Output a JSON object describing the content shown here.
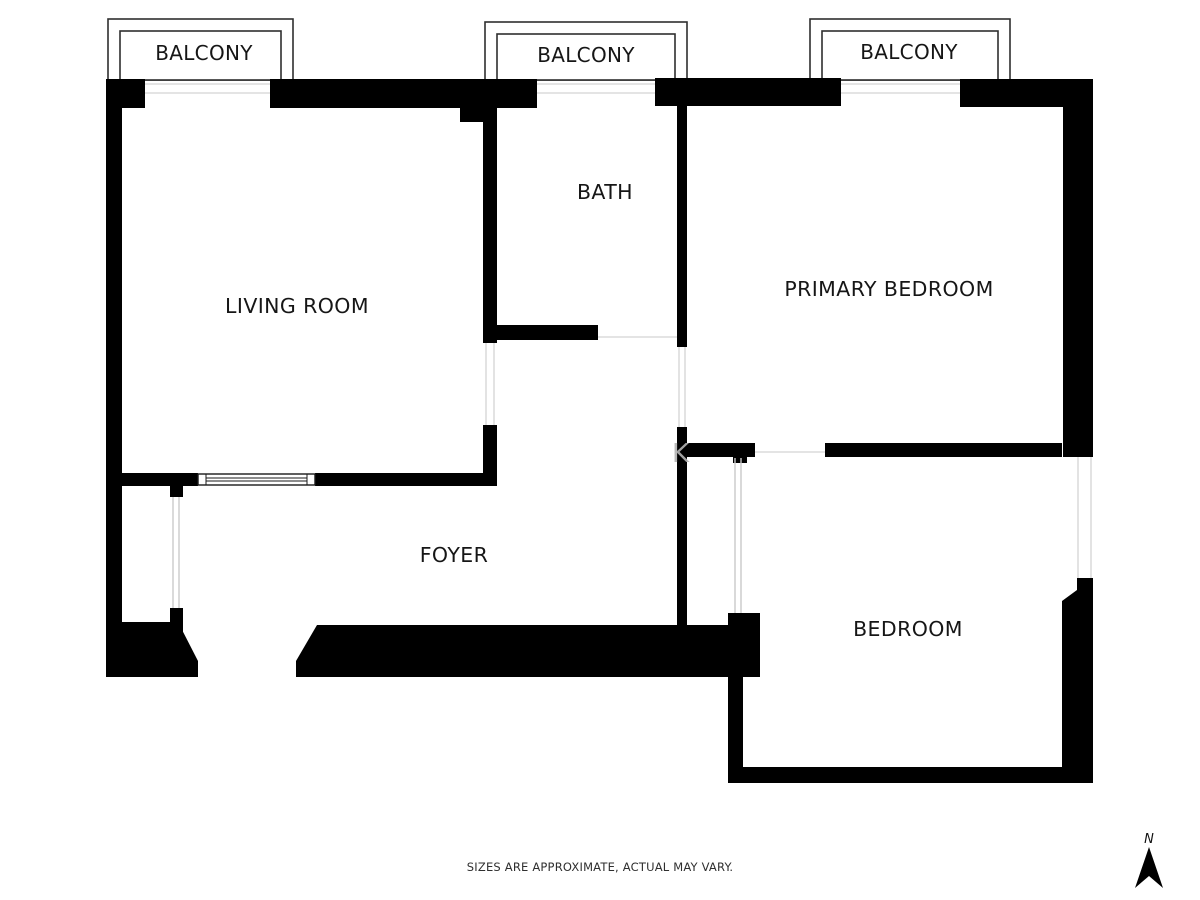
{
  "floorplan": {
    "rooms": [
      {
        "id": "living-room",
        "label": "LIVING ROOM"
      },
      {
        "id": "bath",
        "label": "BATH"
      },
      {
        "id": "primary-bedroom",
        "label": "PRIMARY BEDROOM"
      },
      {
        "id": "foyer",
        "label": "FOYER"
      },
      {
        "id": "bedroom",
        "label": "BEDROOM"
      }
    ],
    "balconies": [
      {
        "id": "balcony-left",
        "label": "BALCONY"
      },
      {
        "id": "balcony-center",
        "label": "BALCONY"
      },
      {
        "id": "balcony-right",
        "label": "BALCONY"
      }
    ],
    "watermark_letter": "K",
    "compass": {
      "label": "N"
    },
    "disclaimer": "SIZES ARE APPROXIMATE, ACTUAL MAY VARY.",
    "colors": {
      "wall": "#000000",
      "background": "#ffffff",
      "outline": "#2f2f2f",
      "faint_line": "#dcdcdc",
      "text": "#161616",
      "watermark": "#b3b3b3"
    }
  }
}
